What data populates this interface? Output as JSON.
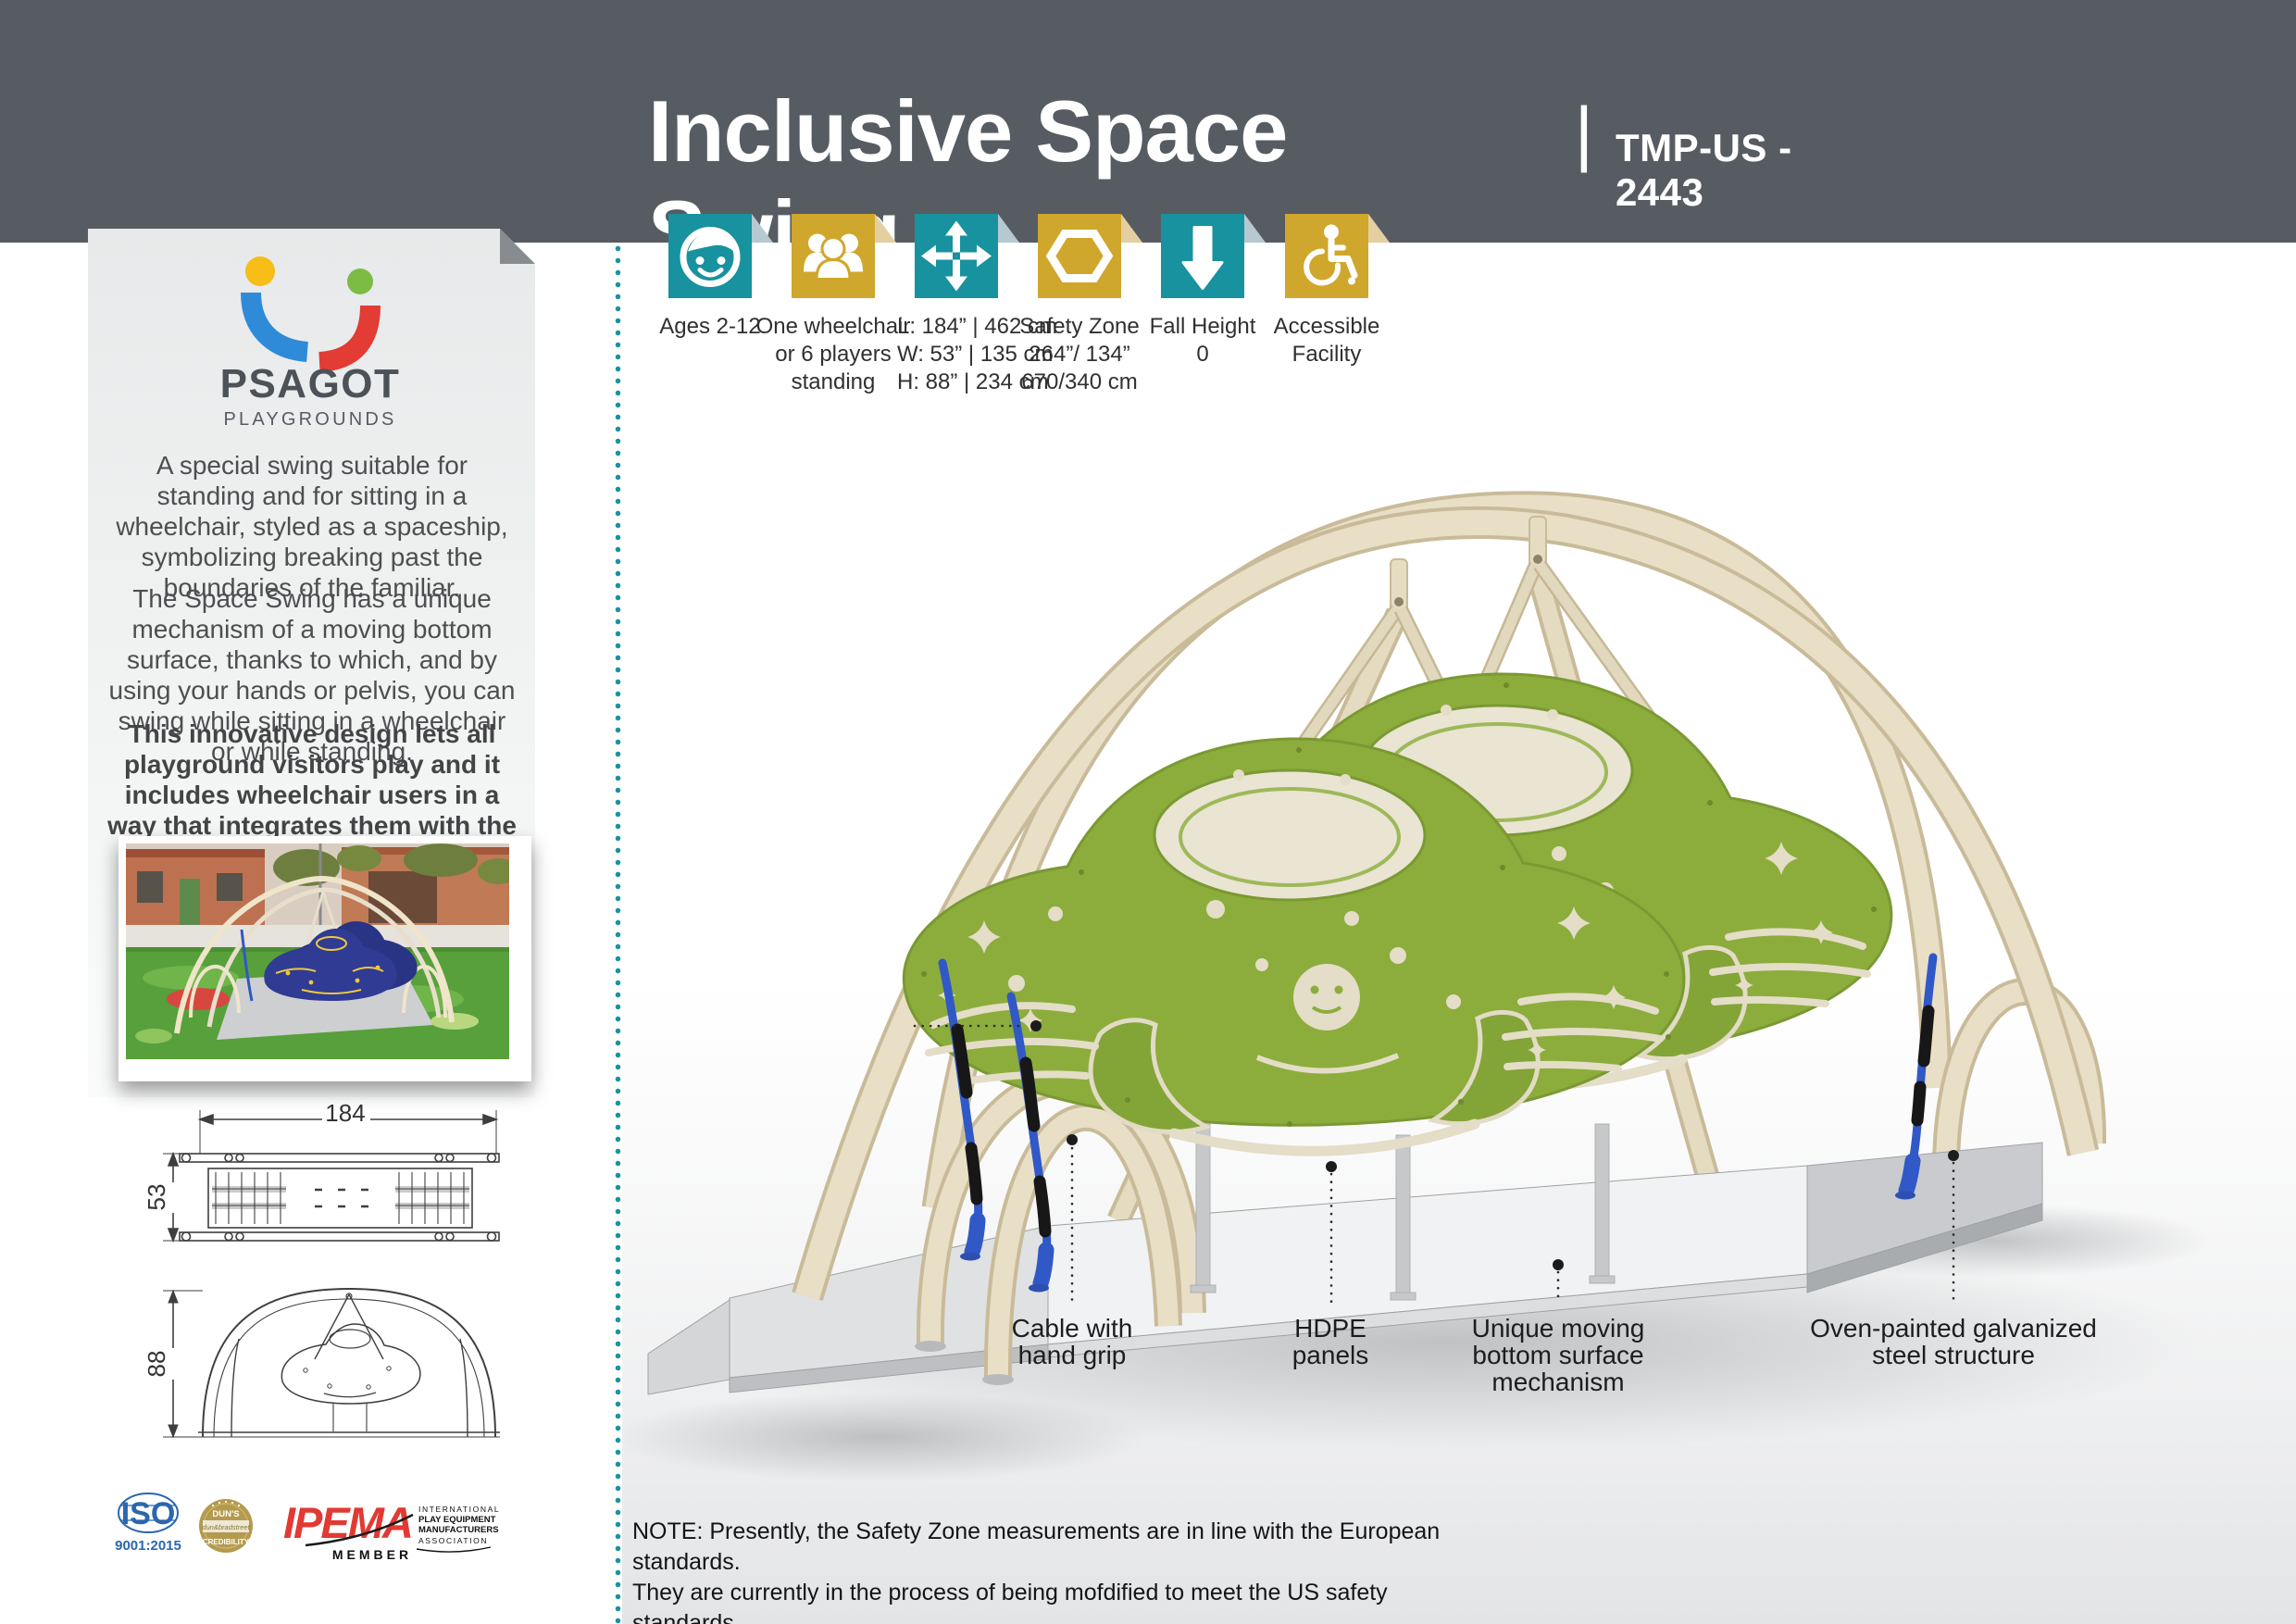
{
  "header": {
    "title": "Inclusive Space Swing",
    "divider": "|",
    "code": "TMP-US - 2443"
  },
  "specs": [
    {
      "icon": "child-face",
      "label_lines": [
        "Ages 2-12"
      ]
    },
    {
      "icon": "players-group",
      "label_lines": [
        "One wheelchair",
        "or 6 players",
        "standing"
      ]
    },
    {
      "icon": "four-way-arrows",
      "label_lines": [
        "L: 184” | 462 cm",
        "W: 53” | 135 cm",
        "H: 88” | 234 cm"
      ]
    },
    {
      "icon": "hexagon-safety-zone",
      "label_lines": [
        "Safety Zone",
        "264”/ 134”",
        "670/340 cm"
      ]
    },
    {
      "icon": "fall-height-arrow",
      "label_lines": [
        "Fall Height",
        "0"
      ]
    },
    {
      "icon": "wheelchair-accessible",
      "label_lines": [
        "Accessible",
        "Facility"
      ]
    }
  ],
  "sidebar": {
    "brand": {
      "name": "PSAGOT",
      "tagline": "PLAYGROUNDS"
    },
    "paragraph1": "A special swing suitable for standing and for sitting in a wheelchair, styled as a spaceship, symbolizing breaking past the boundaries of the familiar.",
    "paragraph2": "The Space Swing has a unique mechanism of a moving bottom surface, thanks to which, and by using your hands or pelvis, you can swing while sitting in a wheelchair or while standing.",
    "paragraph3": "This innovative design lets all playground visitors play and it includes wheelchair users in a way that integrates them with the other players.",
    "drawings": {
      "top_length": "184",
      "top_width": "53",
      "front_height": "88"
    },
    "certs": {
      "iso": {
        "name": "ISO",
        "standard": "9001:2015"
      },
      "duns": {
        "top": "DUN'S",
        "mid": "dun&bradstreet",
        "bottom": "CREDIBILITY"
      },
      "ipema": {
        "name": "IPEMA",
        "member": "MEMBER",
        "assoc": [
          "INTERNATIONAL",
          "PLAY EQUIPMENT",
          "MANUFACTURERS",
          "ASSOCIATION"
        ]
      }
    }
  },
  "annotations": [
    {
      "lines": [
        "Cable with",
        "hand grip"
      ]
    },
    {
      "lines": [
        "HDPE",
        "panels"
      ]
    },
    {
      "lines": [
        "Unique moving",
        "bottom surface",
        "mechanism"
      ]
    },
    {
      "lines": [
        "Oven-painted galvanized",
        "steel structure"
      ]
    }
  ],
  "note": {
    "line1": "NOTE: Presently, the Safety Zone measurements are in line with the European standards.",
    "line2": "They are currently in the process of being mofdified to meet the US safety standards."
  },
  "colors": {
    "teal": "#17929E",
    "gold": "#CFA72C",
    "header_gray": "#575C62",
    "panel_green": "#8CAD3C",
    "steel_beige": "#E8DFC6",
    "cable_blue": "#3158C7"
  }
}
